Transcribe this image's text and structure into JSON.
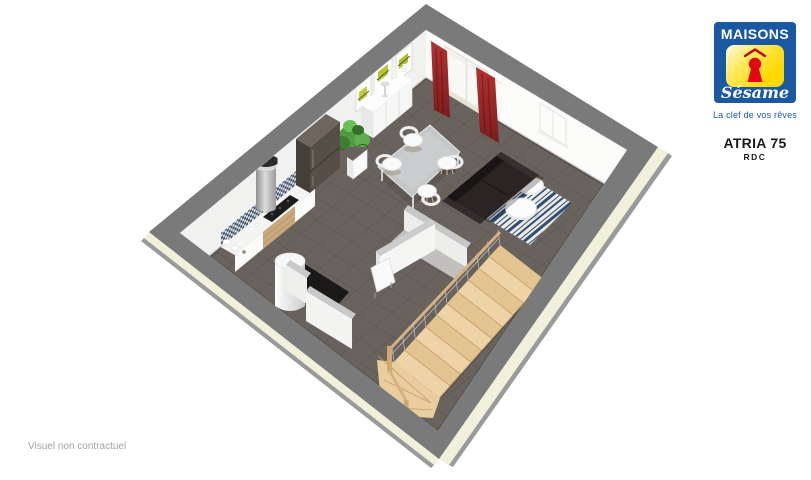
{
  "branding": {
    "logo_title": "MAISONS",
    "logo_script": "Sésame",
    "tagline": "La clef de vos rêves",
    "brand_blue": "#1b58a4",
    "brand_yellow": "#ffd903",
    "brand_red": "#e30617"
  },
  "plan": {
    "model": "ATRIA 75",
    "level": "RDC"
  },
  "footer": {
    "disclaimer": "Visuel non contractuel"
  },
  "floorplan": {
    "view": "3d-isometric-ground-floor",
    "rooms": [
      "kitchen",
      "dining-area",
      "living-area",
      "entry",
      "stair-hall",
      "closet"
    ],
    "objects": [
      "red-curtains",
      "sliding-glass-door",
      "wall-frames",
      "sideboard",
      "potted-plant",
      "extractor-hood",
      "cooktop",
      "kitchen-counter",
      "mosaic-backsplash",
      "refrigerator",
      "water-heater",
      "toilet-paper-rolls",
      "dining-table",
      "dining-chairs",
      "sofa",
      "striped-rug",
      "coffee-tables",
      "window",
      "wooden-staircase",
      "stair-railing"
    ],
    "colors": {
      "wall_top": "#7a7a7a",
      "interior_wall": "#f5f5f3",
      "exterior_facade": "#f2efdb",
      "floor_tile": "#6a635d",
      "stair_wood": "#e9cda0",
      "curtain_red": "#a82a2a",
      "rug_navy": "#2e4d77",
      "sofa": "#2a2522"
    }
  }
}
